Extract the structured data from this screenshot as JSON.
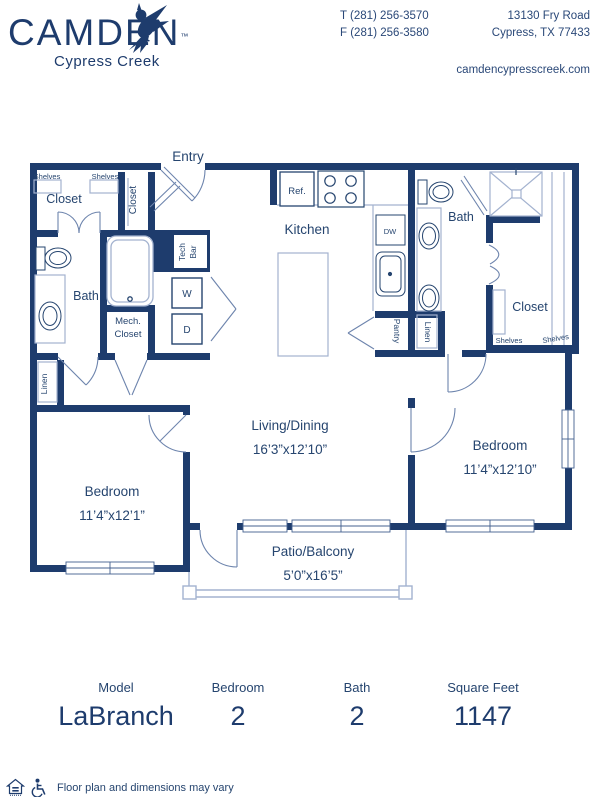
{
  "header": {
    "brand": {
      "name": "CAMDEN",
      "trademark": "™",
      "community": "Cypress Creek"
    },
    "contact": {
      "phone": "T (281) 256-3570",
      "fax": "F (281) 256-3580",
      "address_line1": "13130 Fry Road",
      "address_line2": "Cypress, TX 77433",
      "website": "camdencypresscreek.com"
    }
  },
  "floorplan": {
    "labels": {
      "entry": "Entry",
      "shelves": "Shelves",
      "closet": "Closet",
      "bath": "Bath",
      "linen": "Linen",
      "tech": "Tech",
      "bar": "Bar",
      "washer": "W",
      "dryer": "D",
      "mech": "Mech.",
      "kitchen": "Kitchen",
      "ref": "Ref.",
      "dw": "DW",
      "pantry": "Pantry",
      "living": "Living/Dining",
      "living_dim": "16’3”x12’10”",
      "bedroom": "Bedroom",
      "bedroom1_dim": "11’4”x12’1”",
      "bedroom2_dim": "11’4”x12’10”",
      "patio": "Patio/Balcony",
      "patio_dim": "5’0”x16’5”"
    }
  },
  "summary": {
    "columns": [
      {
        "label": "Model",
        "value": "LaBranch"
      },
      {
        "label": "Bedroom",
        "value": "2"
      },
      {
        "label": "Bath",
        "value": "2"
      },
      {
        "label": "Square Feet",
        "value": "1147"
      }
    ]
  },
  "footer": {
    "disclaimer": "Floor plan and dimensions may vary"
  },
  "colors": {
    "navy": "#1e3c6d",
    "line": "#a3b2cf"
  }
}
